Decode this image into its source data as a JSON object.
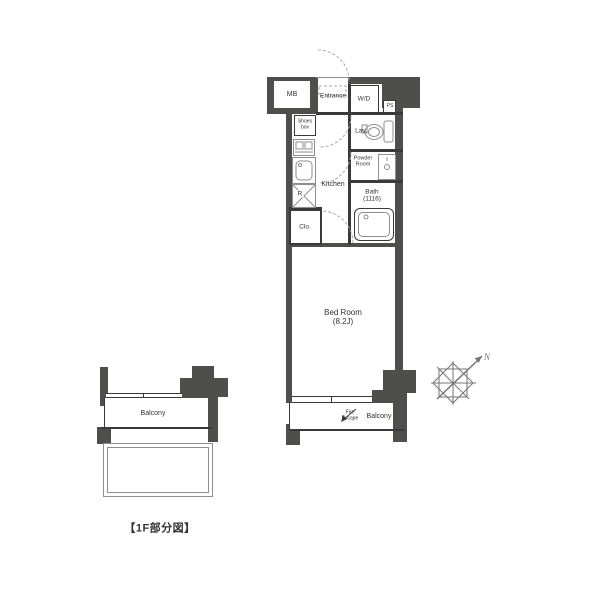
{
  "title": "apartment-floor-plan",
  "colors": {
    "wall": "#4e4e4d",
    "line": "#3a3a3a",
    "fixture": "#8e8e8e",
    "text": "#333333",
    "dashed": "#aaaaaa",
    "compass": "#767676"
  },
  "main_plan": {
    "mb_label": "MB",
    "entrance_label": "Entrance",
    "wd_label": "W/D",
    "ps_label": "PS",
    "shoes_box_line1": "Shoes",
    "shoes_box_line2": "box",
    "lav_label": "Lav.",
    "powder_line1": "Powder",
    "powder_line2": "Room",
    "kitchen_label": "Kitchen",
    "refrigerator_label": "R",
    "bath_label": "Bath",
    "bath_size": "(1116)",
    "closet_label": "Clo.",
    "bedroom_label": "Bed Room",
    "bedroom_size": "(8.2J)",
    "fire_escape_line1": "Fire",
    "fire_escape_line2": "Escape",
    "balcony_label": "Balcony"
  },
  "partial_plan": {
    "balcony_label": "Balcony",
    "caption": "【1F部分図】"
  },
  "compass": {
    "north_label": "N"
  }
}
